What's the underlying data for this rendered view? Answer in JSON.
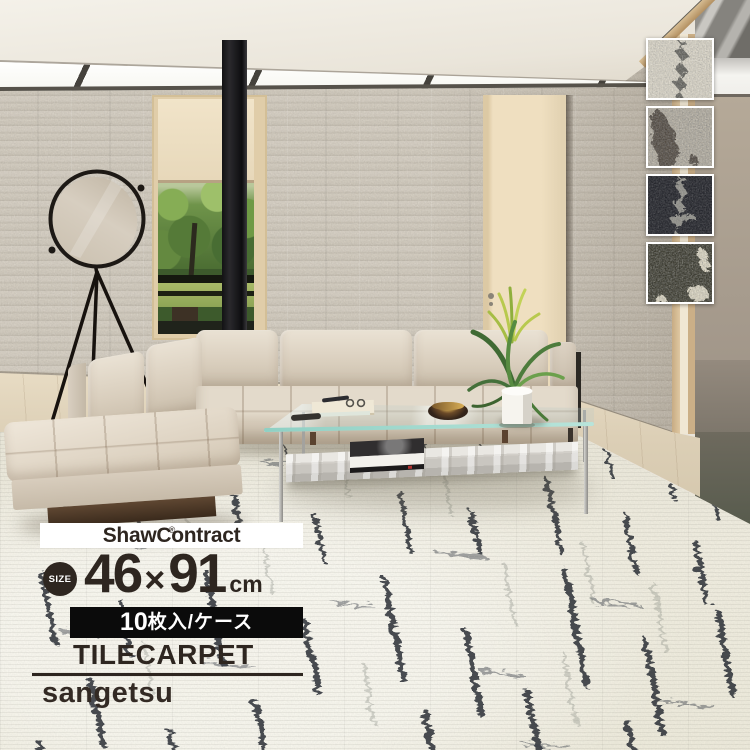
{
  "product": {
    "brand": "ShawContract",
    "brand_reg": "®",
    "size_label": "SIZE",
    "size_w": "46",
    "size_times": "×",
    "size_h": "91",
    "size_unit": "cm",
    "case_count": "10",
    "case_text": "枚入/ケース",
    "category": "TILECARPET",
    "maker": "sangetsu"
  },
  "swatches": [
    {
      "name": "colorway-light-beige",
      "base": "#d7d2c4",
      "streak": "#63625c"
    },
    {
      "name": "colorway-greige",
      "base": "#b3ada0",
      "streak": "#524b42"
    },
    {
      "name": "colorway-charcoal",
      "base": "#24252b",
      "streak": "#93928b"
    },
    {
      "name": "colorway-dark-olive",
      "base": "#3b3a2e",
      "streak": "#d9d3bf"
    }
  ],
  "colors": {
    "overlay_text": "#2e2620",
    "case_bar_bg": "#0b0b0b",
    "brand_box_bg": "#ffffff",
    "carpet_base": "#edeadd",
    "carpet_streak": "#2a2f36"
  }
}
